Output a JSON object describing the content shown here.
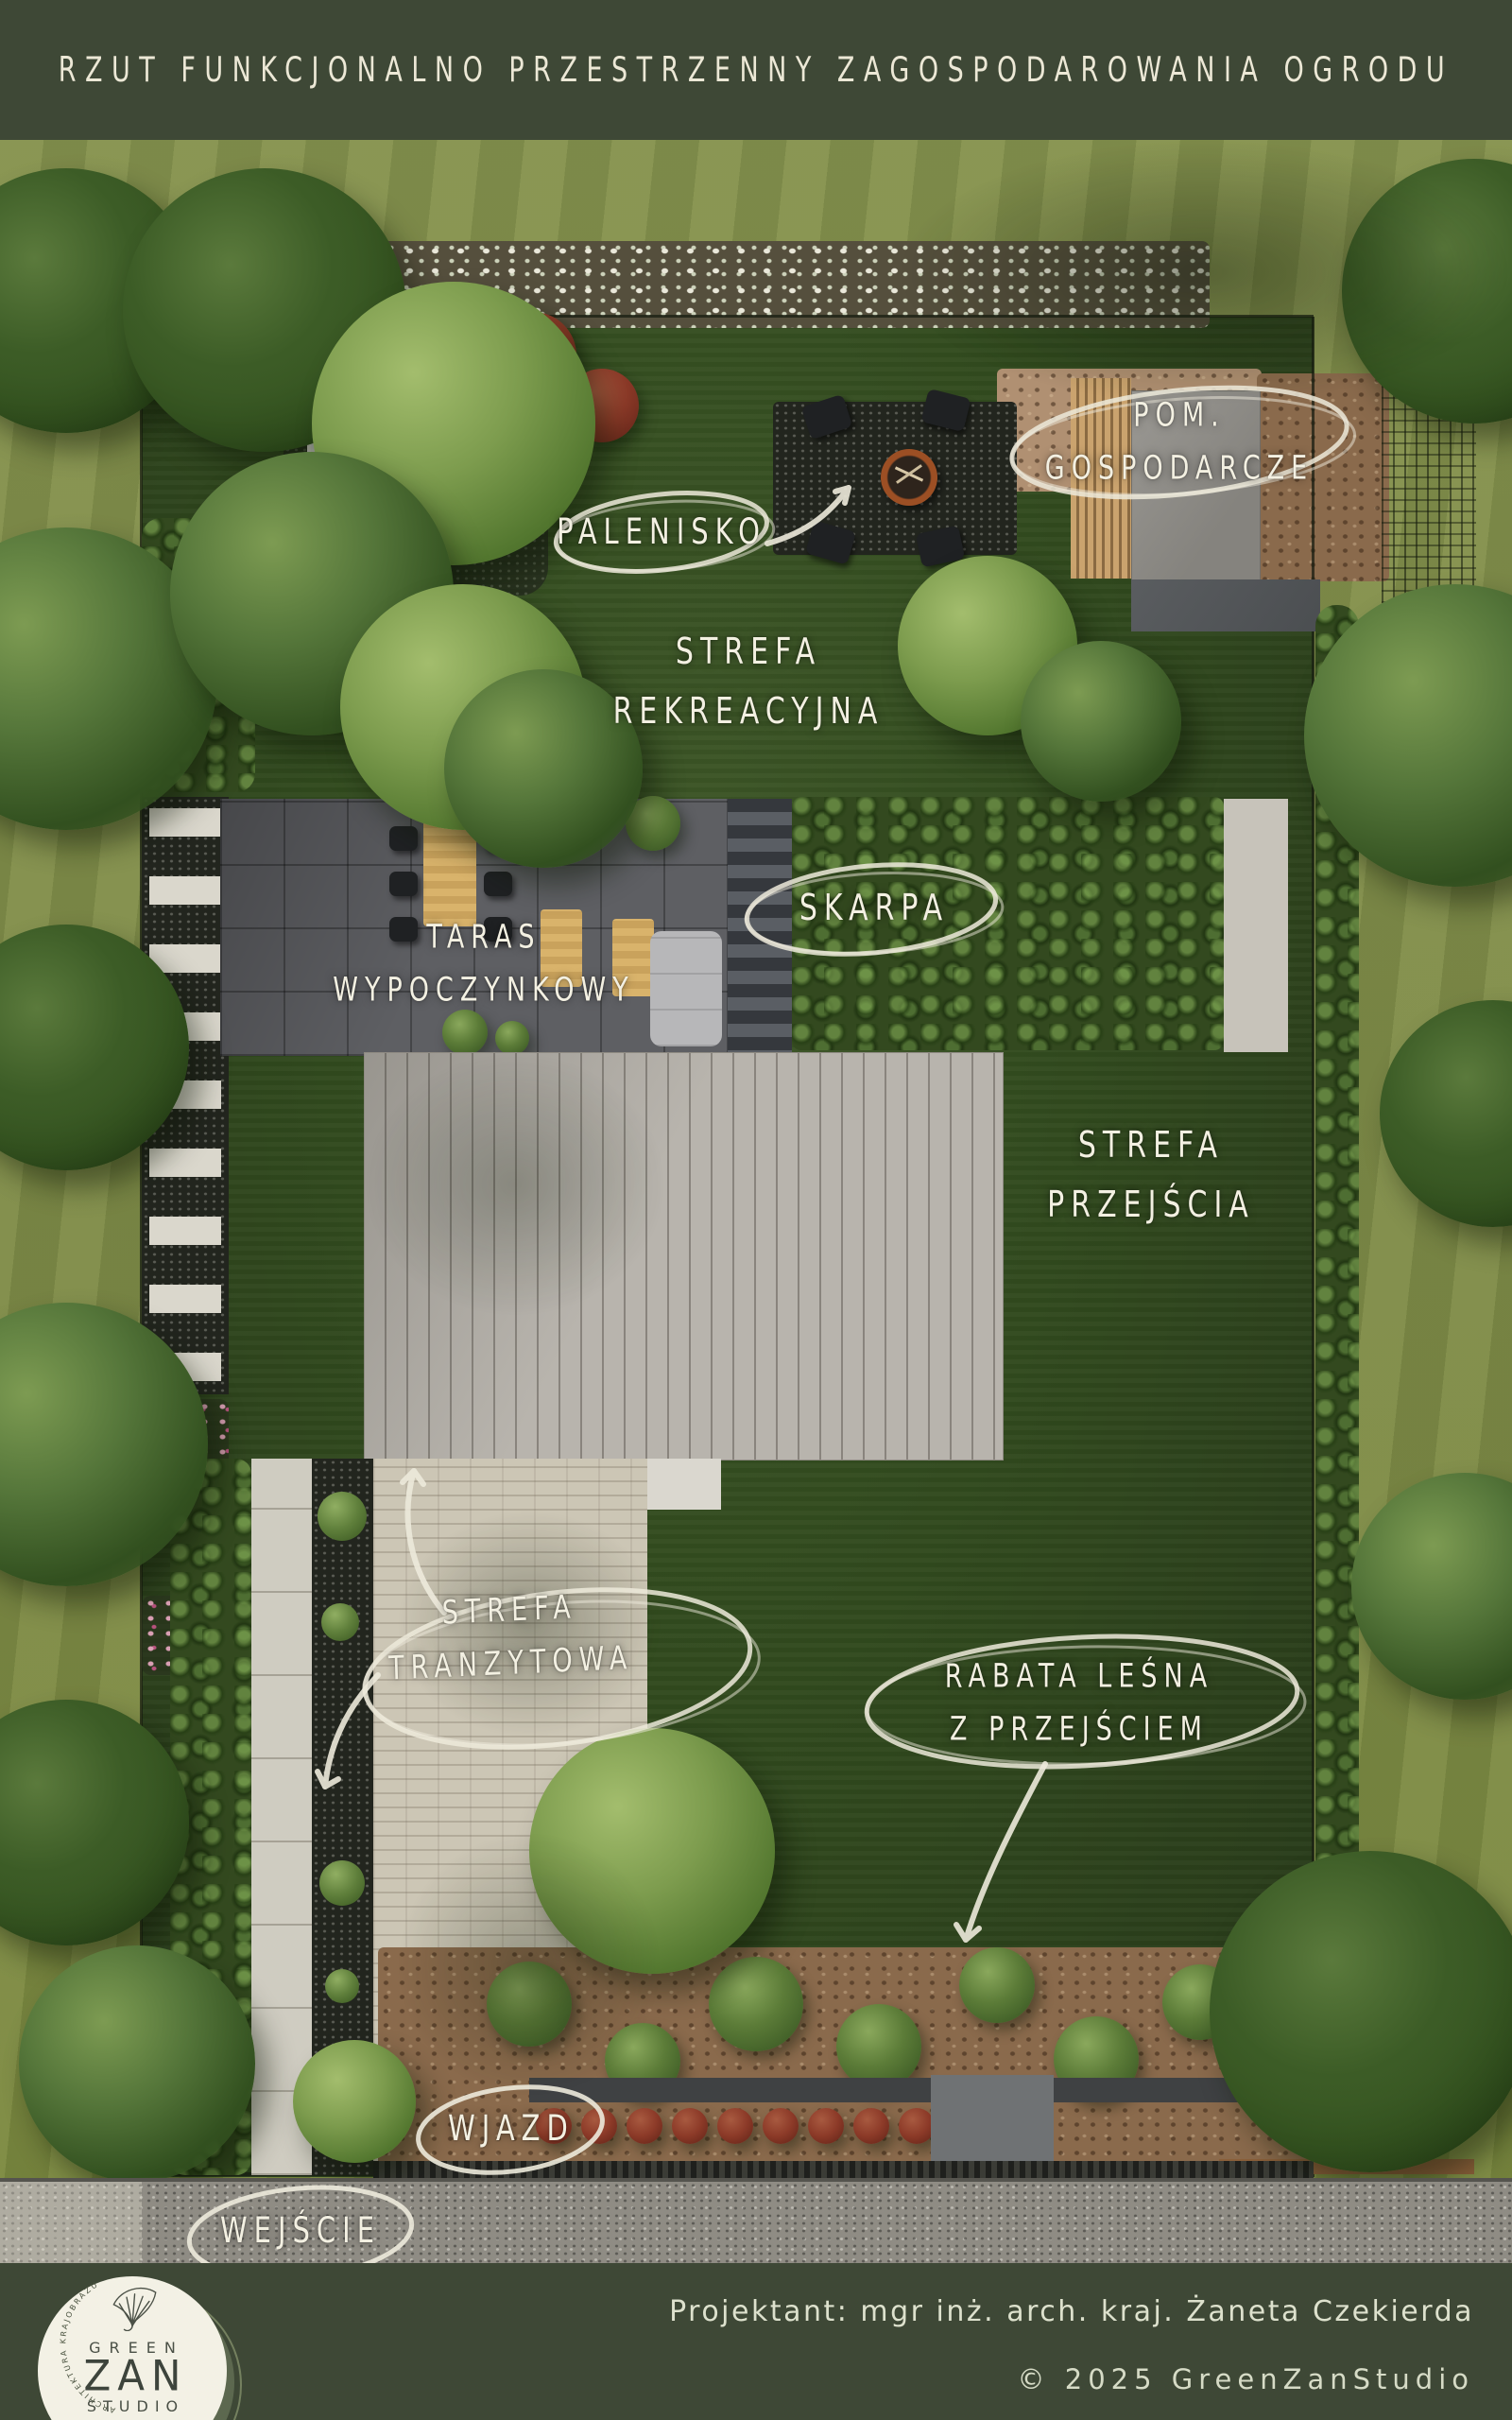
{
  "header": {
    "title": "RZUT FUNKCJONALNO PRZESTRZENNY ZAGOSPODAROWANIA OGRODU"
  },
  "labels": {
    "palenisko": {
      "text": "PALENISKO"
    },
    "pom_gospodarcze": {
      "line1": "POM.",
      "line2": "GOSPODARCZE"
    },
    "strefa_rekreacyjna": {
      "line1": "STREFA",
      "line2": "REKREACYJNA"
    },
    "skarpa": {
      "text": "SKARPA"
    },
    "taras_wypoczynkowy": {
      "line1": "TARAS",
      "line2": "WYPOCZYNKOWY"
    },
    "strefa_przejscia": {
      "line1": "STREFA",
      "line2": "PRZEJŚCIA"
    },
    "strefa_tranzytowa": {
      "line1": "STREFA",
      "line2": "TRANZYTOWA"
    },
    "rabata_lesna": {
      "line1": "RABATA LEŚNA",
      "line2": "Z PRZEJŚCIEM"
    },
    "wjazd": {
      "text": "WJAZD"
    },
    "wejscie": {
      "text": "WEJŚCIE"
    }
  },
  "footer": {
    "designer": "Projektant: mgr inż. arch. kraj. Żaneta Czekierda",
    "copyright": "© 2025 GreenZanStudio",
    "logo": {
      "line1": "GREEN",
      "line2": "ZAN",
      "line3": "STUDIO",
      "ring_text": "ARCHITEKTURA KRAJOBRAZU",
      "leaf_icon": "ginkgo-leaf-icon"
    }
  },
  "colors": {
    "frame_green": "#3e4836",
    "title_cream": "#ece8d6",
    "label_cream": "#f3f0e2",
    "outer_lawn": "#7c8947",
    "inner_lawn": "#314a1e",
    "roof_gray": "#b8b4ad",
    "terrace_gray": "#5e5f63",
    "driveway_beige": "#ccc6b5",
    "mulch_brown": "#8a6a4c",
    "road_gravel": "#8f8c84",
    "fire_bowl_corten": "#9c4f24",
    "red_shrub": "#8c3a28"
  }
}
